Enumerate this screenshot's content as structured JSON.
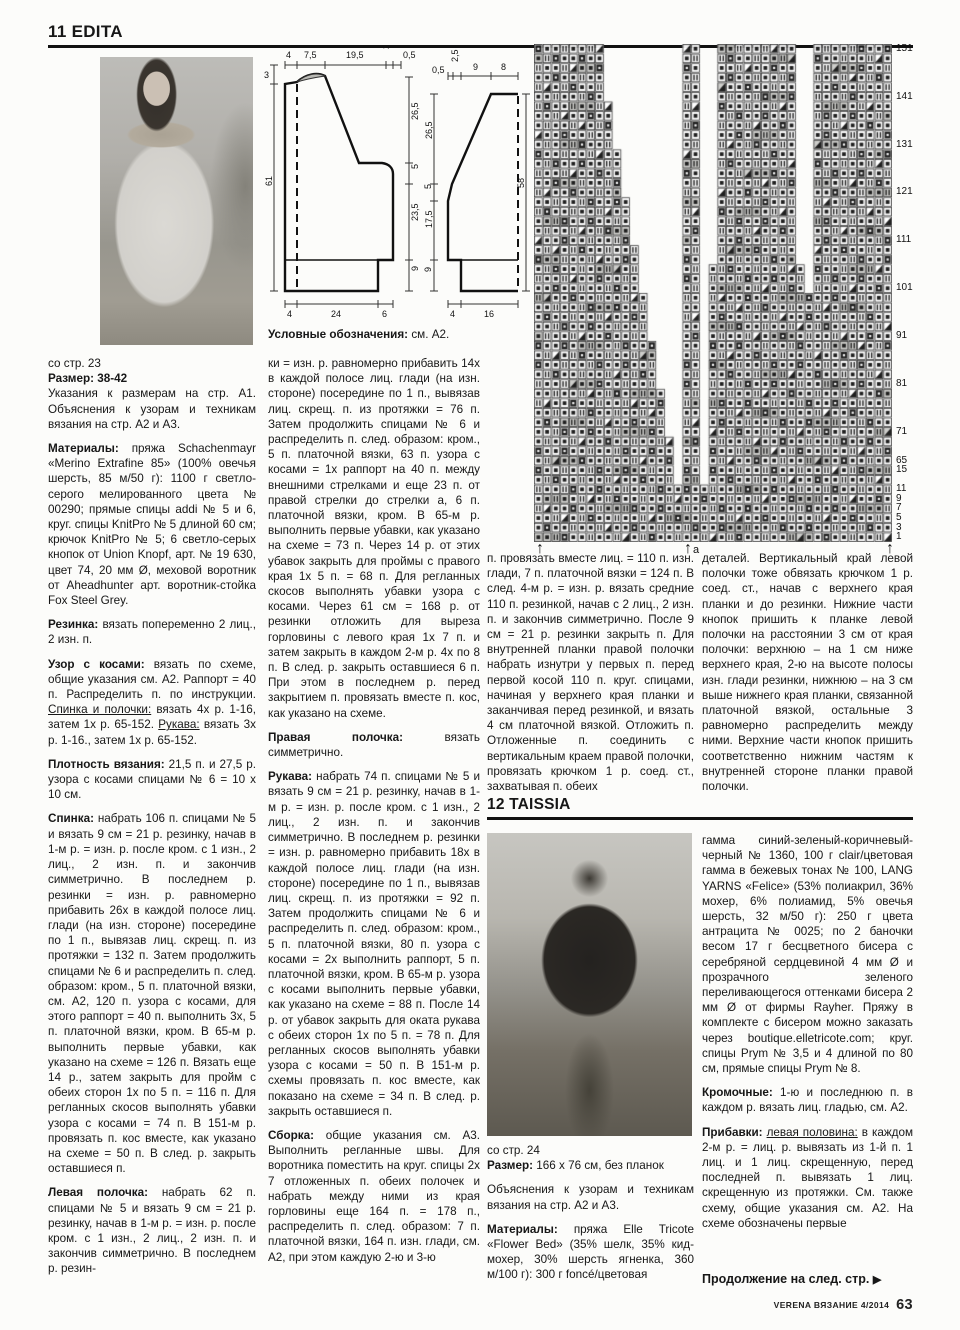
{
  "edita": {
    "header": "11 EDITA",
    "col1": [
      {
        "t": "со стр. 23"
      },
      {
        "b": "Размер: 38-42"
      },
      {
        "t": "Указания к размерам на стр. А1. Объяснения к узорам и техникам вязания на стр. А2 и А3."
      },
      {
        "sp": true,
        "b": "Материалы:",
        "t": "пряжа Schachenmayr «Merino Extrafine 85» (100% овечья шерсть, 85 м/50 г): 1100 г светло-серого мелированного цвета № 00290; прямые спицы addi № 5 и 6, круг. спицы KnitPro № 5 длиной 60 см; крючок KnitPro № 5; 6 светло-серых кнопок от Union Knopf, арт. № 19 630, цвет 74, 20 мм Ø, меховой воротник от Aheadhunter арт. воротник-стойка Fox Steel Grey."
      },
      {
        "sp": true,
        "b": "Резинка:",
        "t": "вязать попеременно 2 лиц., 2 изн. п."
      },
      {
        "sp": true,
        "b": "Узор с косами:",
        "t": "вязать по схеме, общие указания см. А2. Раппорт = 40 п. Распределить п. по инструкции. __Спинка и полочки:__ вязать 4х р. 1-16, затем 1х р. 65-152. __Рукава:__ вязать 3х р. 1-16., затем 1х р. 65-152."
      },
      {
        "sp": true,
        "b": "Плотность вязания:",
        "t": "21,5 п. и 27,5 р. узора с косами спицами № 6 = 10 х 10 см."
      },
      {
        "sp": true,
        "b": "Спинка:",
        "t": "набрать 106 п. спицами № 5 и вязать 9 см = 21 р. резинку, начав в 1-м р. = изн. р. после кром. с 1 изн., 2 лиц., 2 изн. п. и закончив симметрично. В последнем р. резинки = изн. р. равномерно прибавить 26х в каждой полосе лиц. глади (на изн. стороне) посередине по 1 п., вывязав лиц. скрещ. п. из протяжки = 132 п. Затем продолжить спицами № 6 и распределить п. след. образом: кром., 5 п. платочной вязки, см. А2, 120 п. узора с косами, для этого раппорт = 40 п. выполнить 3х, 5 п. платочной вязки, кром. В 65-м р. выполнить первые убавки, как указано на схеме = 126 п. Вязать еще 14 р., затем закрыть для пройм с обеих сторон 1х по 5 п. = 116 п. Для регланных скосов выполнять убавки узора с косами = 74 п. В 151-м р. провязать п. кос вместе, как указано на схеме = 50 п. В след. р. закрыть оставшиеся п."
      },
      {
        "sp": true,
        "b": "Левая полочка:",
        "t": "набрать 62 п. спицами № 5 и вязать 9 см = 21 р. резинку, начав в 1-м р. = изн. р. после кром. с 1 изн., 2 лиц., 2 изн. п. и закончив симметрично. В последнем р. резин-"
      }
    ],
    "col2_legend": [
      {
        "b": "Условные обозначения:",
        "t": "см. А2."
      }
    ],
    "col2": [
      {
        "t": "ки = изн. р. равномерно прибавить 14х в каждой полосе лиц. глади (на изн. стороне) посередине по 1 п., вывязав лиц. скрещ. п. из протяжки = 76 п. Затем продолжить спицами № 6 и распределить п. след. образом: кром., 5 п. платочной вязки, 63 п. узора с косами = 1х раппорт на 40 п. между внешними стрелками и еще 23 п. от правой стрелки до стрелки а, 6 п. платочной вязки, кром. В 65-м р. выполнить первые убавки, как указано на схеме = 73 п. Через 14 р. от этих убавок закрыть для проймы с правого края 1х 5 п. = 68 п. Для регланных скосов выполнять убавки узора с косами. Через 61 см = 168 р. от резинки отложить для выреза горловины с левого края 1х 7 п. и затем закрыть в каждом 2-м р. 4х по 8 п. В след. р. закрыть оставшиеся 6 п. При этом в последнем р. перед закрытием п. провязать вместе п. кос, как указано на схеме."
      },
      {
        "sp": true,
        "b": "Правая полочка:",
        "t": "вязать симметрично."
      },
      {
        "sp": true,
        "b": "Рукава:",
        "t": "набрать 74 п. спицами № 5 и вязать 9 см = 21 р. резинку, начав в 1-м р. = изн. р. после кром. с 1 изн., 2 лиц., 2 изн. п. и закончив симметрично. В последнем р. резинки = изн. р. равномерно прибавить 18х в каждой полосе лиц. глади (на изн. стороне) посередине по 1 п., вывязав лиц. скрещ. п. из протяжки = 92 п. Затем продолжить спицами № 6 и распределить п. след. образом: кром., 5 п. платочной вязки, 80 п. узора с косами = 2х выполнить раппорт, 5 п. платочной вязки, кром. В 65-м р. узора с косами выполнить первые убавки, как указано на схеме = 88 п. После 14 р. от убавок закрыть для оката рукава с обеих сторон 1х по 5 п. = 78 п. Для регланных скосов выполнять убавки узора с косами = 50 п. В 151-м р. схемы провязать п. кос вместе, как показано на схеме = 34 п. В след. р. закрыть оставшиеся п."
      },
      {
        "sp": true,
        "b": "Сборка:",
        "t": "общие указания см. А3. Выполнить регланные швы. Для воротника поместить на круг. спицы 2х 7 отложенных п. обеих полочек и набрать между ними из края горловины еще 164 п. = 178 п., распределить п. след. образом: 7 п. платочной вязки, 164 п. изн. глади, см. А2, при этом каждую 2-ю и 3-ю"
      }
    ],
    "col3_top": [
      {
        "t": "п. провязать вместе лиц. = 110 п. изн. глади, 7 п. платочной вязки = 124 п. В след. 4-м р. = изн. р. вязать средние 110 п. резинкой, начав с 2 лиц., 2 изн. п. и закончив симметрично. После 9 см = 21 р. резинки закрыть п. Для внутренней планки правой полочки набрать изнутри у первых п. перед первой косой 110 п. круг. спицами, начиная у верхнего края планки и заканчивая перед резинкой, и вязать 4 см платочной вязкой. Отложить п. Отложенные п. соединить с вертикальным краем правой полочки, провязать крючком 1 р. соед. ст., захватывая п. обеих"
      }
    ],
    "col4_top": [
      {
        "t": "деталей. Вертикальный край левой полочки тоже обвязать крючком 1 р. соед. ст., начав с верхнего края планки и до резинки. Нижние части кнопок пришить к планке левой полочки на расстоянии 3 см от края полочки: верхнюю – на 1 см ниже верхнего края, 2-ю на высоте полосы изн. глади резинки, нижнюю – на 3 см выше нижнего края планки, связанной платочной вязкой, остальные 3 равномерно распределить между ними. Верхние части кнопок пришить соответственно нижним частям к внутренней стороне планки правой полочки."
      }
    ]
  },
  "taissia": {
    "header": "12 TAISSIA",
    "col3": [
      {
        "t": "со стр. 24"
      },
      {
        "b": "Размер:",
        "t": "166 х 76 см, без планок"
      },
      {
        "sp": true,
        "t": "Объяснения к узорам и техникам вязания на стр. А2 и А3."
      },
      {
        "sp": true,
        "b": "Материалы:",
        "t": "пряжа Elle Tricote «Flower Bed» (35% шелк, 35% кид-мохер, 30% шерсть ягненка, 360 м/100 г): 300 г foncé/цветовая"
      }
    ],
    "col4": [
      {
        "t": "гамма синий-зеленый-коричневый-черный № 1360, 100 г clair/цветовая гамма в бежевых тонах № 100, LANG YARNS «Felice» (53% полиакрил, 36% мохер, 6% полиамид, 5% овечья шерсть, 32 м/50 г): 250 г цвета антрацита № 0025; по 2 баночки весом 17 г бесцветного бисера с серебряной сердцевиной 4 мм Ø и прозрачного зеленого переливающегося оттенками бисера 2 мм Ø от фирмы Rayher. Пряжу в комплекте с бисером можно заказать через boutique.elletricote.com; круг. спицы Prym № 3,5 и 4 длиной по 80 см, прямые спицы Prym № 8."
      },
      {
        "sp": true,
        "b": "Кромочные:",
        "t": "1-ю и последнюю п. в каждом р. вязать лиц. гладью, см. А2."
      },
      {
        "sp": true,
        "b": "Прибавки:",
        "t": "__левая половина:__ в каждом 2-м р. = лиц. р. вывязать из 1-й п. 1 лиц. и 1 лиц. скрещенную, перед последней п. вывязать 1 лиц. скрещенную из протяжки. См. также схему, общие указания см. А2. На схеме обозначены первые"
      }
    ]
  },
  "chart": {
    "row_labels": [
      "151",
      "141",
      "131",
      "121",
      "111",
      "101",
      "91",
      "81",
      "71",
      "65",
      "15",
      "11",
      "9",
      "7",
      "5",
      "3",
      "1"
    ],
    "bottom_marker": "a",
    "arrow_icon": "↑"
  },
  "schematics": {
    "left_piece": {
      "top": [
        "4",
        "7,5",
        "19,5",
        "2,5",
        "0,5"
      ],
      "left": [
        "3",
        "61"
      ],
      "right": [
        "26,5",
        "5",
        "23,5",
        "9"
      ],
      "bottom": [
        "4",
        "24",
        "6"
      ]
    },
    "right_piece": {
      "top": [
        "0,5",
        "2,5",
        "9",
        "8"
      ],
      "left": [
        "26,5",
        "5",
        "17,5",
        "9"
      ],
      "right": [
        "58"
      ],
      "bottom": [
        "4",
        "16"
      ]
    }
  },
  "footer": {
    "continuation": "Продолжение на след. стр.",
    "continuation_arrow": "▶",
    "magazine": "VERENA ВЯЗАНИЕ 4/2014",
    "page_number": "63"
  }
}
